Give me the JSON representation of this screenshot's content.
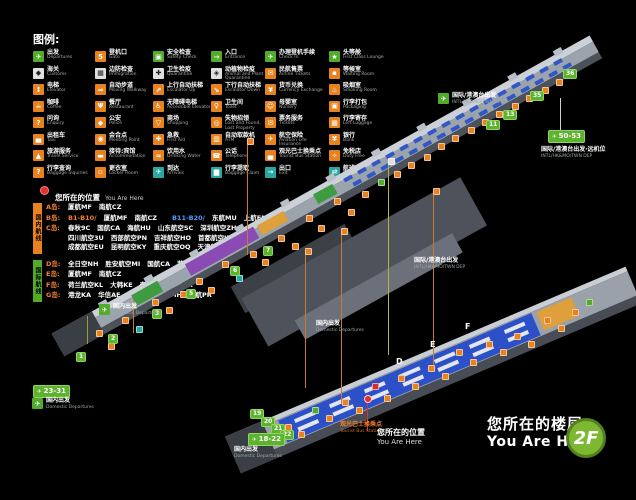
{
  "legend": {
    "title": "图例:",
    "col_widths": [
      62,
      58,
      58,
      54,
      64,
      76
    ],
    "columns": [
      [
        {
          "cn": "出发",
          "en": "Departures",
          "c": "gr",
          "g": "✈",
          "icon": "departures-icon"
        },
        {
          "cn": "海关",
          "en": "Customs",
          "c": "wh",
          "g": "◆",
          "icon": "customs-icon"
        },
        {
          "cn": "电梯",
          "en": "Elevator",
          "c": "or",
          "g": "↕",
          "icon": "elevator-icon"
        },
        {
          "cn": "咖啡",
          "en": "Coffee",
          "c": "or",
          "g": "☕",
          "icon": "coffee-icon"
        },
        {
          "cn": "问询",
          "en": "Enquiry",
          "c": "or",
          "g": "?",
          "icon": "enquiry-icon"
        },
        {
          "cn": "出租车",
          "en": "Taxi",
          "c": "or",
          "g": "▄",
          "icon": "taxi-icon"
        },
        {
          "cn": "旅游服务",
          "en": "Travel Service",
          "c": "or",
          "g": "▲",
          "icon": "travel-service-icon"
        },
        {
          "cn": "行李查询",
          "en": "Baggage Inquiries",
          "c": "or",
          "g": "?",
          "icon": "baggage-inquiries-icon"
        }
      ],
      [
        {
          "cn": "登机口",
          "en": "Gate",
          "c": "or",
          "g": "5",
          "icon": "gate-icon"
        },
        {
          "cn": "边防检查",
          "en": "Immigration",
          "c": "wh",
          "g": "▦",
          "icon": "immigration-icon"
        },
        {
          "cn": "自动步道",
          "en": "Moving Walkway",
          "c": "or",
          "g": "⇒",
          "icon": "moving-walkway-icon"
        },
        {
          "cn": "餐厅",
          "en": "Restaurant",
          "c": "or",
          "g": "Ψ",
          "icon": "restaurant-icon"
        },
        {
          "cn": "公安",
          "en": "Police",
          "c": "or",
          "g": "◆",
          "icon": "police-icon"
        },
        {
          "cn": "会合点",
          "en": "Meeting Point",
          "c": "or",
          "g": "◉",
          "icon": "meeting-point-icon"
        },
        {
          "cn": "接待:宾馆",
          "en": "Accommodation",
          "c": "or",
          "g": "▬",
          "icon": "accommodation-icon"
        },
        {
          "cn": "更衣室",
          "en": "Locker Room",
          "c": "or",
          "g": "▫",
          "icon": "locker-room-icon"
        }
      ],
      [
        {
          "cn": "安全检查",
          "en": "Safety Check",
          "c": "gr",
          "g": "▣",
          "icon": "safety-check-icon"
        },
        {
          "cn": "卫生检疫",
          "en": "Quarantine",
          "c": "wh",
          "g": "✚",
          "icon": "quarantine-icon"
        },
        {
          "cn": "上行自动扶梯",
          "en": "Escalator Up",
          "c": "or",
          "g": "⇗",
          "icon": "escalator-up-icon"
        },
        {
          "cn": "无障碍电梯",
          "en": "Accessible Elevator",
          "c": "or",
          "g": "♿",
          "icon": "accessible-elevator-icon"
        },
        {
          "cn": "商场",
          "en": "Shopping",
          "c": "or",
          "g": "▽",
          "icon": "shopping-icon"
        },
        {
          "cn": "急救",
          "en": "First Aid",
          "c": "or",
          "g": "✚",
          "icon": "first-aid-icon"
        },
        {
          "cn": "饮用水",
          "en": "Drinking Water",
          "c": "or",
          "g": "≈",
          "icon": "drinking-water-icon"
        },
        {
          "cn": "到达",
          "en": "Arrivals",
          "c": "tl",
          "g": "✈",
          "icon": "arrivals-icon"
        }
      ],
      [
        {
          "cn": "入口",
          "en": "Entrance",
          "c": "gr",
          "g": "→",
          "icon": "entrance-icon"
        },
        {
          "cn": "动植物检疫",
          "en": "Animal and Plant Quarantine",
          "c": "wh",
          "g": "◈",
          "icon": "animal-plant-quarantine-icon"
        },
        {
          "cn": "下行自动扶梯",
          "en": "Escalator Down",
          "c": "or",
          "g": "⇘",
          "icon": "escalator-down-icon"
        },
        {
          "cn": "卫生间",
          "en": "Toilet",
          "c": "or",
          "g": "♀",
          "icon": "toilet-icon"
        },
        {
          "cn": "失物招领",
          "en": "Lost and Found, Lost Property",
          "c": "or",
          "g": "◎",
          "icon": "lost-and-found-icon"
        },
        {
          "cn": "自动取款机",
          "en": "ATM",
          "c": "or",
          "g": "▥",
          "icon": "atm-icon"
        },
        {
          "cn": "公话",
          "en": "Telephone",
          "c": "or",
          "g": "☎",
          "icon": "telephone-icon"
        },
        {
          "cn": "行李提取",
          "en": "Baggage Claim",
          "c": "tl",
          "g": "▆",
          "icon": "baggage-claim-icon"
        }
      ],
      [
        {
          "cn": "办理登机手续",
          "en": "Check In",
          "c": "gr",
          "g": "✈",
          "icon": "check-in-icon"
        },
        {
          "cn": "民航售票",
          "en": "Airline Tickets",
          "c": "or",
          "g": "✉",
          "icon": "airline-tickets-icon"
        },
        {
          "cn": "货币兑换",
          "en": "Currency Exchange",
          "c": "or",
          "g": "¥",
          "icon": "currency-exchange-icon"
        },
        {
          "cn": "母婴室",
          "en": "Nursery",
          "c": "or",
          "g": "☺",
          "icon": "nursery-icon"
        },
        {
          "cn": "票务服务",
          "en": "Tickets",
          "c": "or",
          "g": "✉",
          "icon": "tickets-icon"
        },
        {
          "cn": "航空保险",
          "en": "Aviation Life Insurance",
          "c": "or",
          "g": "✈",
          "icon": "aviation-insurance-icon"
        },
        {
          "cn": "观光巴士换乘点",
          "en": "Tourist Bus Station",
          "c": "or",
          "g": "▄",
          "icon": "tourist-bus-icon"
        },
        {
          "cn": "出口",
          "en": "Exit",
          "c": "tl",
          "g": "→",
          "icon": "exit-icon"
        }
      ],
      [
        {
          "cn": "头等舱",
          "en": "First Class Lounge",
          "c": "gr",
          "g": "★",
          "icon": "first-class-lounge-icon"
        },
        {
          "cn": "等候室",
          "en": "Waiting Room",
          "c": "or",
          "g": "▪",
          "icon": "waiting-room-icon"
        },
        {
          "cn": "吸烟室",
          "en": "Smoking Room",
          "c": "or",
          "g": "♨",
          "icon": "smoking-room-icon"
        },
        {
          "cn": "行李打包",
          "en": "Packaging",
          "c": "or",
          "g": "▣",
          "icon": "packaging-icon"
        },
        {
          "cn": "行李寄存",
          "en": "Left Luggage",
          "c": "or",
          "g": "▦",
          "icon": "left-luggage-icon"
        },
        {
          "cn": "银行",
          "en": "Bank",
          "c": "or",
          "g": "¥",
          "icon": "bank-icon"
        },
        {
          "cn": "免税店",
          "en": "Duty Free",
          "c": "or",
          "g": "✧",
          "icon": "duty-free-icon"
        },
        {
          "cn": "航班中转联程",
          "en": "Connecting Flight",
          "c": "tl",
          "g": "⇄",
          "icon": "connecting-flight-icon"
        }
      ]
    ]
  },
  "you_are_here": {
    "cn": "您所在的位置",
    "en": "You Are Here"
  },
  "airlines": {
    "domestic_tag": "国内航线",
    "international_tag": "国际航线",
    "rows": [
      {
        "label": "A岛:",
        "group": "dom",
        "lines": [
          [
            {
              "t": "厦航MF"
            },
            {
              "t": "南航CZ"
            }
          ]
        ]
      },
      {
        "label": "B岛:",
        "group": "dom",
        "lines": [
          [
            {
              "t": "B1-B10/",
              "c": "or"
            },
            {
              "t": "厦航MF"
            },
            {
              "t": "南航CZ"
            },
            {
              "t": "B11-B20/",
              "c": "bl"
            },
            {
              "t": "东航MU"
            },
            {
              "t": "上航FM"
            }
          ]
        ]
      },
      {
        "label": "C岛:",
        "group": "dom",
        "lines": [
          [
            {
              "t": "春秋9C"
            },
            {
              "t": "国航CA"
            },
            {
              "t": "海航HU"
            },
            {
              "t": "山东航空SC"
            },
            {
              "t": "深圳航空ZH"
            }
          ],
          [
            {
              "t": "四川航空3U"
            },
            {
              "t": "西部航空PN"
            },
            {
              "t": "吉祥航空HO"
            },
            {
              "t": "首都航空JD"
            }
          ],
          [
            {
              "t": "成都航空EU"
            },
            {
              "t": "昆明航空KY"
            },
            {
              "t": "重庆航空OQ"
            },
            {
              "t": "天津航空GS"
            }
          ]
        ]
      },
      {
        "label": "D岛:",
        "group": "intl",
        "lines": [
          [
            {
              "t": "全日空NH"
            },
            {
              "t": "胜安航空MI"
            },
            {
              "t": "国航CA"
            },
            {
              "t": "菲航PR"
            }
          ]
        ]
      },
      {
        "label": "E岛:",
        "group": "intl",
        "lines": [
          [
            {
              "t": "厦航MF"
            },
            {
              "t": "南航CZ"
            }
          ]
        ]
      },
      {
        "label": "F岛:",
        "group": "intl",
        "lines": [
          [
            {
              "t": "荷兰航空KL"
            },
            {
              "t": "大韩KE"
            },
            {
              "t": "泰航TG"
            },
            {
              "t": "澳航NX"
            }
          ]
        ]
      },
      {
        "label": "G岛:",
        "group": "intl",
        "lines": [
          [
            {
              "t": "港龙KA"
            },
            {
              "t": "华信AE"
            },
            {
              "t": "立荣B7"
            },
            {
              "t": "马航MH"
            },
            {
              "t": "菲航PR"
            }
          ]
        ]
      }
    ]
  },
  "map": {
    "gates": [
      [
        "1",
        76,
        352
      ],
      [
        "2",
        108,
        334
      ],
      [
        "3",
        152,
        309
      ],
      [
        "5",
        186,
        289
      ],
      [
        "6",
        230,
        266
      ],
      [
        "7",
        263,
        246
      ],
      [
        "11",
        486,
        120
      ],
      [
        "13",
        503,
        110
      ],
      [
        "35",
        530,
        91
      ],
      [
        "36",
        563,
        69
      ],
      [
        "19",
        250,
        409
      ],
      [
        "20",
        261,
        417
      ],
      [
        "21",
        271,
        424
      ],
      [
        "22",
        280,
        430
      ]
    ],
    "range_badges": [
      [
        "23-31",
        33,
        385
      ],
      [
        "18-22",
        248,
        433
      ],
      [
        "50-53",
        548,
        130
      ]
    ],
    "intl_label": {
      "cn": "国际/港澳台出发",
      "en": "INTL/HK&MO/TWN DEP"
    },
    "intl_positions": [
      [
        452,
        93,
        1
      ],
      [
        414,
        258,
        0
      ]
    ],
    "far_stand": {
      "cn": "国际/港澳台出发·远机位",
      "en": "INTL/HK&MO/TWN DEP",
      "x": 541,
      "y": 147
    },
    "dom_label": {
      "cn": "国内出发",
      "en": "Domestic Departures"
    },
    "dom_positions": [
      [
        113,
        304,
        1
      ],
      [
        316,
        321,
        0
      ],
      [
        46,
        398,
        1
      ],
      [
        234,
        447,
        0
      ]
    ],
    "bus_label": {
      "cn": "观光巴士换乘点",
      "en": "Tourist Bus Station",
      "x": 340,
      "y": 422
    },
    "you_are_here": {
      "cn": "您所在的位置",
      "en": "You Are Here"
    },
    "floor": {
      "cn": "您所在的楼层",
      "en": "You Are Here",
      "badge": "2F"
    },
    "island_letters": [
      [
        "D",
        396,
        357
      ],
      [
        "E",
        430,
        340
      ],
      [
        "F",
        465,
        322
      ]
    ],
    "vlines": [
      [
        247,
        143,
        112,
        "#c87a30"
      ],
      [
        305,
        253,
        135,
        "#c87a30"
      ],
      [
        341,
        233,
        170,
        "#c87a30"
      ],
      [
        388,
        163,
        192,
        "#b8b43a"
      ],
      [
        433,
        193,
        172,
        "#c87a30"
      ],
      [
        87,
        316,
        28,
        "#9aa030"
      ],
      [
        133,
        299,
        34,
        "#c87a30"
      ],
      [
        560,
        98,
        32,
        "#cfcfcf"
      ],
      [
        367,
        401,
        30,
        "#e03030"
      ]
    ],
    "icons": [
      [
        96,
        330,
        "or",
        "toilet-icon"
      ],
      [
        108,
        343,
        "or",
        "restaurant-icon"
      ],
      [
        122,
        317,
        "or",
        "shopping-icon"
      ],
      [
        136,
        326,
        "tl",
        "baggage-claim-icon"
      ],
      [
        152,
        299,
        "or",
        "escalator-up-icon"
      ],
      [
        166,
        307,
        "or",
        "coffee-icon"
      ],
      [
        180,
        291,
        "or",
        "atm-icon"
      ],
      [
        196,
        278,
        "or",
        "toilet-icon"
      ],
      [
        208,
        287,
        "or",
        "shopping-icon"
      ],
      [
        222,
        261,
        "or",
        "restaurant-icon"
      ],
      [
        236,
        275,
        "tl",
        "arrivals-icon"
      ],
      [
        250,
        251,
        "or",
        "escalator-up-icon"
      ],
      [
        262,
        259,
        "or",
        "enquiry-icon"
      ],
      [
        278,
        235,
        "or",
        "toilet-icon"
      ],
      [
        292,
        243,
        "or",
        "shopping-icon"
      ],
      [
        306,
        215,
        "or",
        "restaurant-icon"
      ],
      [
        318,
        225,
        "or",
        "coffee-icon"
      ],
      [
        334,
        198,
        "or",
        "escalator-up-icon"
      ],
      [
        348,
        209,
        "or",
        "toilet-icon"
      ],
      [
        362,
        191,
        "or",
        "shopping-icon"
      ],
      [
        378,
        179,
        "gr",
        "safety-check-icon"
      ],
      [
        394,
        171,
        "or",
        "restaurant-icon"
      ],
      [
        408,
        162,
        "or",
        "atm-icon"
      ],
      [
        424,
        154,
        "or",
        "toilet-icon"
      ],
      [
        438,
        143,
        "or",
        "shopping-icon"
      ],
      [
        452,
        135,
        "or",
        "coffee-icon"
      ],
      [
        468,
        127,
        "or",
        "escalator-up-icon"
      ],
      [
        482,
        119,
        "or",
        "toilet-icon"
      ],
      [
        496,
        111,
        "or",
        "restaurant-icon"
      ],
      [
        512,
        103,
        "or",
        "shopping-icon"
      ],
      [
        526,
        95,
        "or",
        "toilet-icon"
      ],
      [
        542,
        87,
        "or",
        "smoking-room-icon"
      ],
      [
        556,
        79,
        "or",
        "restaurant-icon"
      ],
      [
        247,
        138,
        "or",
        "restaurant-icon"
      ],
      [
        305,
        248,
        "or",
        "toilet-icon"
      ],
      [
        341,
        228,
        "or",
        "shopping-icon"
      ],
      [
        388,
        158,
        "wh",
        "quarantine-icon"
      ],
      [
        433,
        188,
        "or",
        "coffee-icon"
      ],
      [
        285,
        424,
        "or",
        "check-in-icon"
      ],
      [
        298,
        431,
        "or",
        "toilet-icon"
      ],
      [
        312,
        407,
        "gr",
        "check-in-icon"
      ],
      [
        326,
        415,
        "or",
        "currency-exchange-icon"
      ],
      [
        342,
        399,
        "or",
        "restaurant-icon"
      ],
      [
        356,
        407,
        "or",
        "toilet-icon"
      ],
      [
        372,
        383,
        "rd",
        "first-aid-icon"
      ],
      [
        384,
        395,
        "or",
        "shopping-icon"
      ],
      [
        398,
        375,
        "or",
        "atm-icon"
      ],
      [
        412,
        383,
        "or",
        "coffee-icon"
      ],
      [
        428,
        365,
        "or",
        "toilet-icon"
      ],
      [
        442,
        373,
        "or",
        "restaurant-icon"
      ],
      [
        456,
        349,
        "or",
        "left-luggage-icon"
      ],
      [
        470,
        359,
        "or",
        "shopping-icon"
      ],
      [
        486,
        341,
        "or",
        "toilet-icon"
      ],
      [
        500,
        349,
        "or",
        "telephone-icon"
      ],
      [
        514,
        333,
        "or",
        "restaurant-icon"
      ],
      [
        528,
        341,
        "or",
        "coffee-icon"
      ],
      [
        544,
        317,
        "or",
        "toilet-icon"
      ],
      [
        558,
        325,
        "or",
        "shopping-icon"
      ],
      [
        572,
        309,
        "or",
        "escalator-up-icon"
      ],
      [
        586,
        299,
        "gr",
        "entrance-icon"
      ]
    ]
  }
}
